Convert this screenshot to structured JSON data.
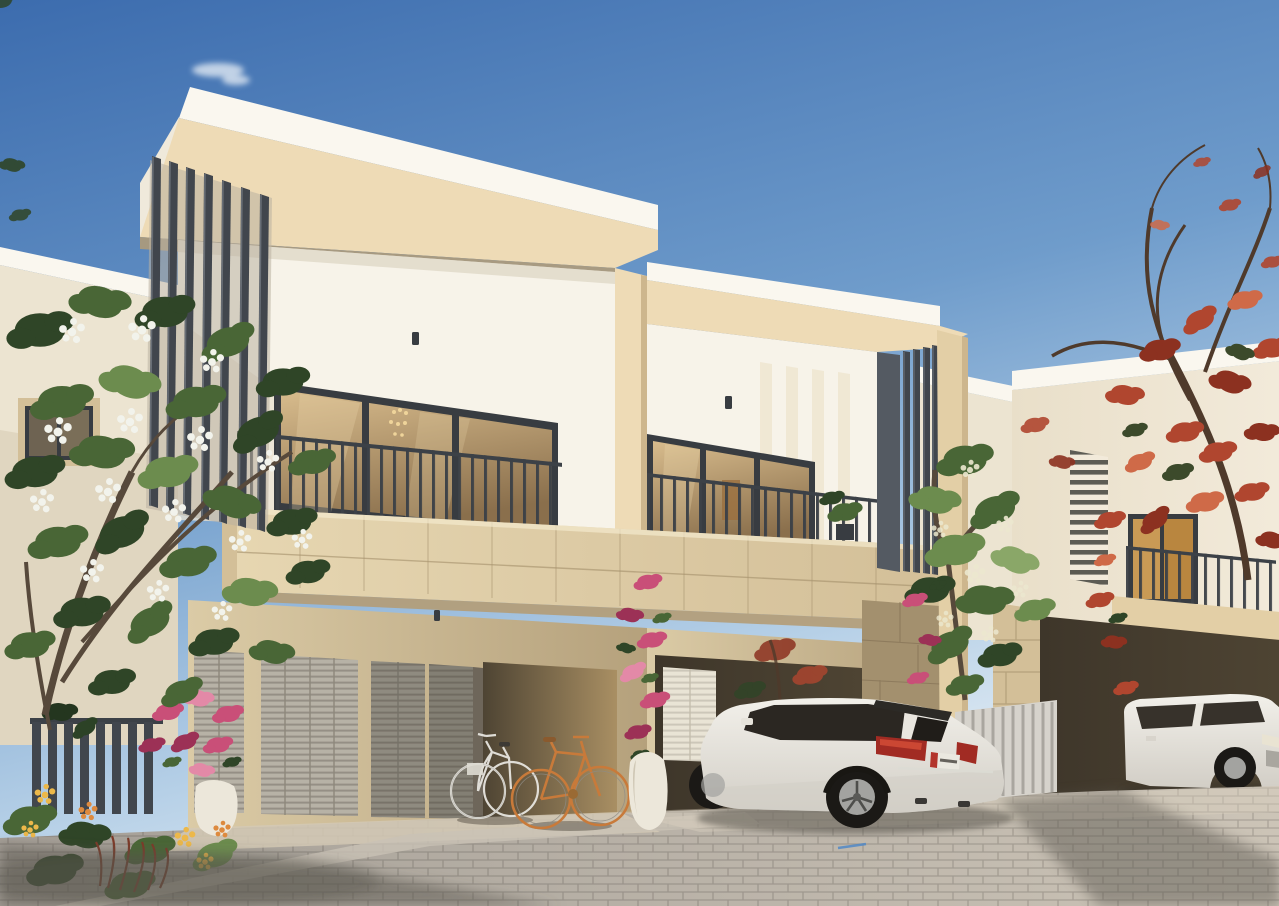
{
  "meta": {
    "title": "Architectural exterior render",
    "description": "Photorealistic daytime render of two modern two-storey townhouse units with dark vertical louver fins, amber-glazed balconies over stone parapets, louvered garage doors, a carport with two bicycles, a white SUV parked in front, a neighbouring villa with a red poinciana tree on the right, and a white-flowering plumeria tree in the left foreground.",
    "units": 2,
    "cars": 2,
    "bicycles": 2
  },
  "palette": {
    "sky_top": "#3c6cae",
    "sky_mid": "#6f9ccb",
    "sky_low": "#b6d0e7",
    "sky_horizon": "#e2ecf4",
    "cloud": "#f4f8fb",
    "cap_white": "#faf7ef",
    "cap_shade": "#efe9db",
    "fascia_lit": "#eedbb6",
    "fascia_mid": "#e3cfa6",
    "fascia_dark": "#cdb68d",
    "fascia_soffit": "#b49c76",
    "facade_white": "#f7f3e9",
    "facade_shade": "#e8e1d1",
    "facade_shadow": "#d6ccb8",
    "fin_dark": "#41464d",
    "fin_mid": "#545a62",
    "fin_light": "#6d737b",
    "fin_back": "#b9b1a1",
    "slat_dark": "#4c4c45",
    "frame_dark": "#383c41",
    "railing": "#3c4147",
    "glass_hi": "#d8bc8d",
    "glass_lo": "#8a6f4c",
    "glass_deep": "#5e4c38",
    "glass_warm": "#c99a55",
    "chandelier": "#efd49a",
    "stone_lit": "#e6d6b1",
    "stone_mid": "#d3bf98",
    "stone_joint": "#a8946f",
    "ground_lit": "#dbcba6",
    "ground_mid": "#b5a17c",
    "carport_deep": "#4e4433",
    "backwall_lit": "#a98f63",
    "garage_door": "#b7b2a6",
    "garage_door_shade": "#8f8b80",
    "louver_line": "rgba(60,55,45,0.28)",
    "door_white": "#e9e4d5",
    "stonewall_shade": "#a3906e",
    "pave_left": "#a49e96",
    "pave_right": "#ccc4b7",
    "pave_joint": "rgba(50,45,40,0.22)",
    "apron": "#d3c9b5",
    "curb": "#c9c2b5",
    "shadow_ground": "#57534c",
    "screen_light": "#d6d3cc",
    "screen_dark": "#a9a69f",
    "car_hi": "#f2f0ea",
    "car_lo": "#d2cec6",
    "car_dark": "#23201c",
    "car_glass": "#2b2722",
    "tail_red": "#a12b23",
    "tail_red_hi": "#cf4a35",
    "plate_white": "#eae8e0",
    "plate_red": "#b3342c",
    "chrome": "#dcdcd4",
    "rim_silver": "#a3a3a0",
    "tire": "#1b1916",
    "bike_white": "#e7e5df",
    "bike_orange": "#c87a3a",
    "saddle_brown": "#8a5a2e",
    "green_dark": "#2f4527",
    "green_mid": "#496636",
    "green_light": "#6c8c4e",
    "green_pale": "#8aa768",
    "flower_white": "#f2f3ec",
    "flower_cream": "#ece8cf",
    "bougain_pink": "#c94f78",
    "bougain_deep": "#9c3156",
    "bougain_light": "#e389a7",
    "lantana_yellow": "#ecb84a",
    "lantana_orange": "#dd8a3e",
    "grass_red": "#7c3a28",
    "poin_red": "#b0462f",
    "poin_deep": "#8c3120",
    "poin_light": "#cf6a48",
    "poin_green": "#3c4a2b",
    "branch_brown": "#4f3a2b",
    "trunk_gray": "#57493b",
    "vase_white": "#ece7da",
    "vase_shade": "#cfc7b5",
    "bg_house_wall": "#ece4d1",
    "bg_house_wall2": "#e0d6c0",
    "rh_face": "#f2eada",
    "rh_face2": "#e9dfc9",
    "carport2_deep": "#3e362a",
    "blue_mark": "#4a86c8",
    "suv2_glass": "#37322b"
  },
  "scene": {
    "sky": {
      "label": "clear blue sky with small wispy clouds"
    },
    "main_building": {
      "label": "two attached modern townhouse units",
      "left_unit": {
        "roof": "white cap over beige portal frame",
        "louver_fins": 7,
        "balcony": "amber glass sliding doors behind metal railing",
        "garage_doors": 4
      },
      "right_unit": {
        "louver_fins": 5,
        "balcony": "glass doors, railing, potted plant",
        "carport": "white louvered door, red tree behind"
      }
    },
    "vehicles": {
      "suv_main": {
        "label": "white luxury SUV, rear three-quarter view",
        "plate": "white plate with red band"
      },
      "suv_right": {
        "label": "white SUV parked under neighbouring carport"
      }
    },
    "bicycles": {
      "left": "white step-through city bike",
      "right": "orange fixie bike"
    },
    "vegetation": {
      "plumeria": "large white-flowering tree, left foreground",
      "poinciana": "red flowering tree, top right",
      "jasmine": "green tree with cream blossoms between buildings",
      "bougainvillea": "pink climbers on pillars with white urn planters",
      "flower_bed": "yellow and orange lantana with red grasses behind dark slatted fence"
    },
    "neighbour_house": {
      "label": "villa with horizontal louver strip, lit window, balcony and stone pillar"
    },
    "ground": {
      "label": "gray paver driveway with long tree shadows and sunlit apron"
    }
  }
}
